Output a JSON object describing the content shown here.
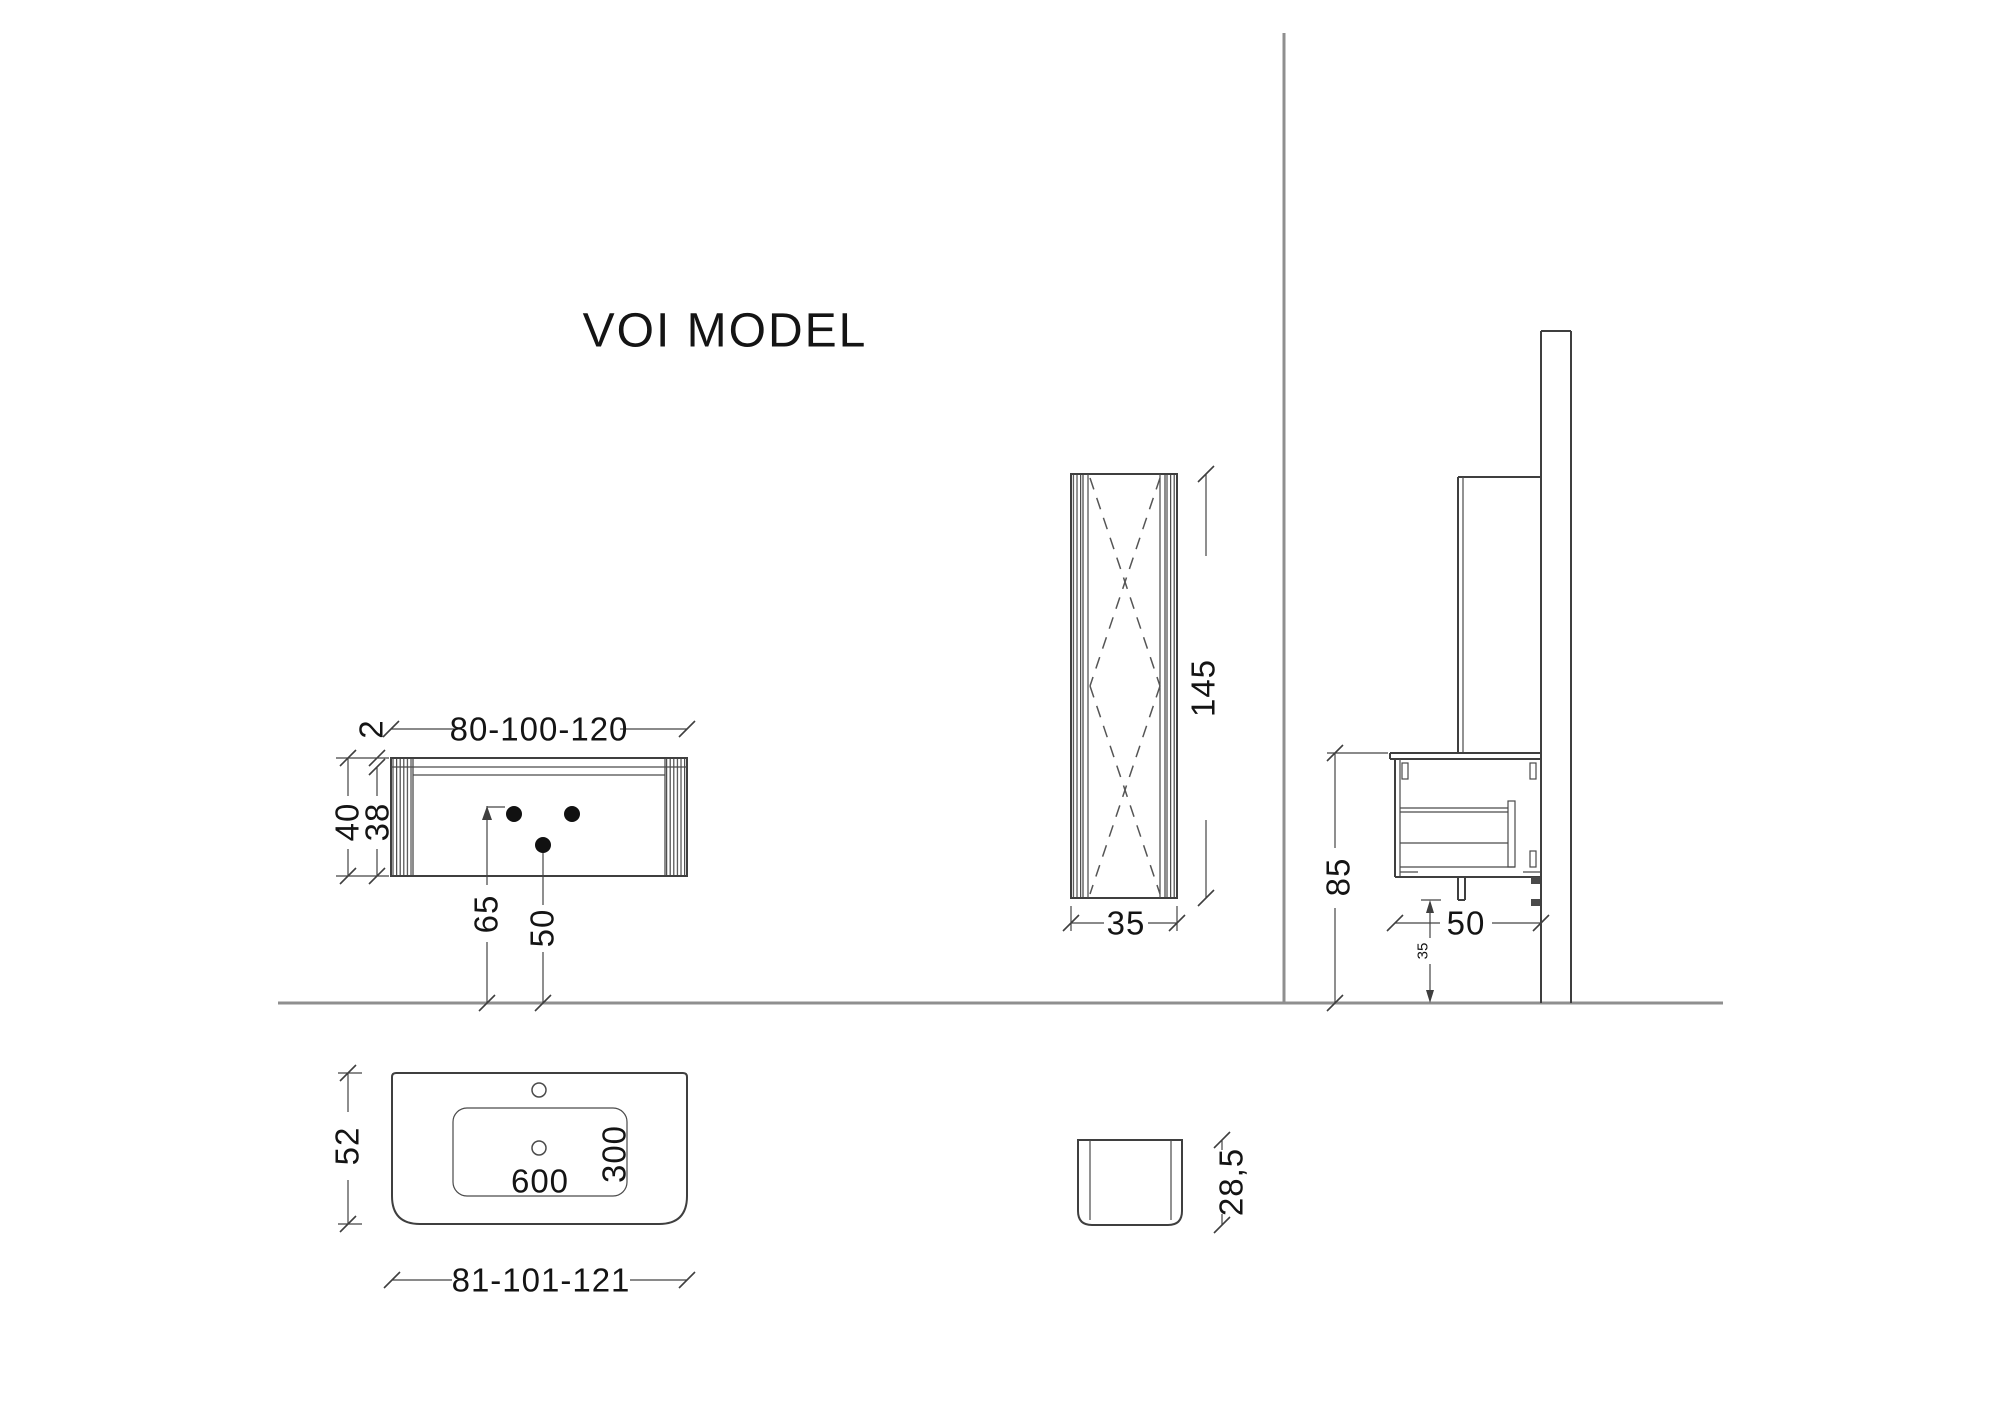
{
  "title": "VOI MODEL",
  "colors": {
    "background": "#ffffff",
    "drawing_line": "#3f3f3f",
    "wall_floor_line": "#8f8f8f",
    "text": "#141414"
  },
  "front_view": {
    "width": "80-100-120",
    "counter_thickness": "2",
    "height_total": "40",
    "height_body": "38",
    "supply_height": "65",
    "drain_height": "50"
  },
  "tall_cabinet_view": {
    "height": "145",
    "depth": "35"
  },
  "side_view": {
    "counter_height": "85",
    "depth": "50",
    "trap_height": "35"
  },
  "basin_plan_view": {
    "depth": "52",
    "bowl_width": "600",
    "bowl_depth": "300",
    "width": "81-101-121"
  },
  "basin_profile_view": {
    "height": "28,5"
  }
}
